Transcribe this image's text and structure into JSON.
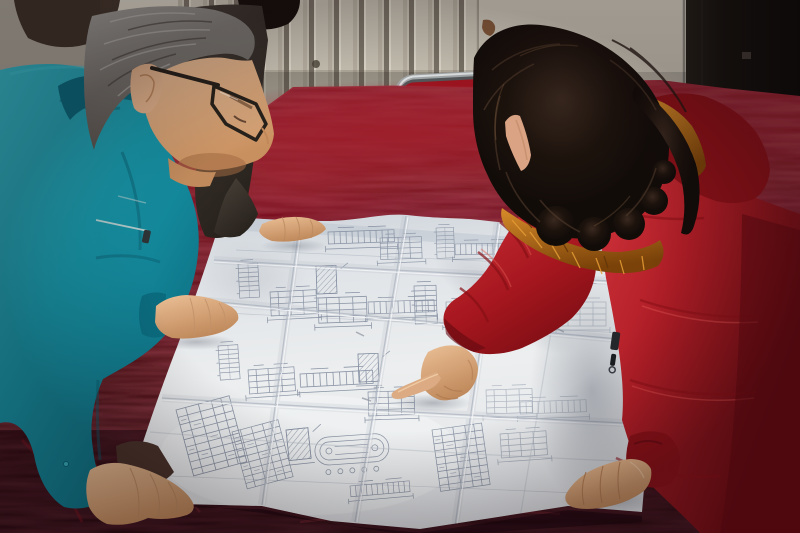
{
  "scene": {
    "title": "Three people leaning over a large folded engineering blueprint spread on a table covered with dark red velvet",
    "setting": "Indoor room with a beige radiator wall, light wall panel and a dark door at right, chrome-framed chair behind the table",
    "figures": [
      {
        "id": "man-in-teal",
        "label": "Older man in teal work jacket with glasses, both hands on the drawing"
      },
      {
        "id": "third-person",
        "label": "Partially hidden person in a dark coat, one hand resting on the top edge of the drawing"
      },
      {
        "id": "woman-in-red",
        "label": "Woman in a red hooded down coat with orange fur trim, pointing at the drawing with her index finger"
      }
    ],
    "objects": [
      {
        "id": "blueprint",
        "label": "Large white folded construction drawing with many small structural details and schedule tables"
      },
      {
        "id": "table",
        "label": "Table draped in dark maroon velvet"
      },
      {
        "id": "chair",
        "label": "Chrome tube chair with red backrest behind the table"
      }
    ]
  },
  "palette": {
    "wall": "#d6d0c2",
    "wallShade": "#bcb5a5",
    "wallLeft": "#9b958a",
    "darkPatch": "#37291f",
    "radFin": "#6b6457",
    "stain": "#7c4a26",
    "door": "#16130f",
    "doorEdge": "#8a877e",
    "chrome": "#aab0b2",
    "chromeHi": "#e9eded",
    "chromeLo": "#565b5d",
    "chairRed": "#a31520",
    "velvetBright": "#8c1622",
    "velvet": "#5c0c16",
    "velvetDark": "#2c050c",
    "velvetDeep": "#1c0307",
    "velvetSheen": "#a13040",
    "paper": "#e7eaec",
    "paperBright": "#f4f5f6",
    "paperShade": "#b9c0cb",
    "crease": "#b2b9c4",
    "creaseHi": "#f6f7f9",
    "ink": "#7e899c",
    "inkFaint": "#9aa4b4",
    "teal": "#1797a9",
    "tealLight": "#3cbac8",
    "tealDark": "#0b6b7e",
    "tealDeep": "#07505f",
    "cuffBrown": "#4a332a",
    "coatRed": "#c22730",
    "coatRedLight": "#e0524f",
    "coatRedDark": "#8c1118",
    "coatRedDeep": "#620a10",
    "fur": "#b26114",
    "furLight": "#e59d36",
    "furDark": "#5f3408",
    "hairW": "#17100c",
    "hairWHi": "#57402f",
    "hairM": "#8e8c88",
    "hairMDark": "#4b4742",
    "hairMLight": "#c9c8c4",
    "skin": "#e4b58d",
    "skinShadow": "#bd8a5d",
    "skinDeep": "#9c6a42",
    "glasses": "#27211b",
    "darkCoat": "#433b34",
    "darkCoatDeep": "#27211d"
  }
}
